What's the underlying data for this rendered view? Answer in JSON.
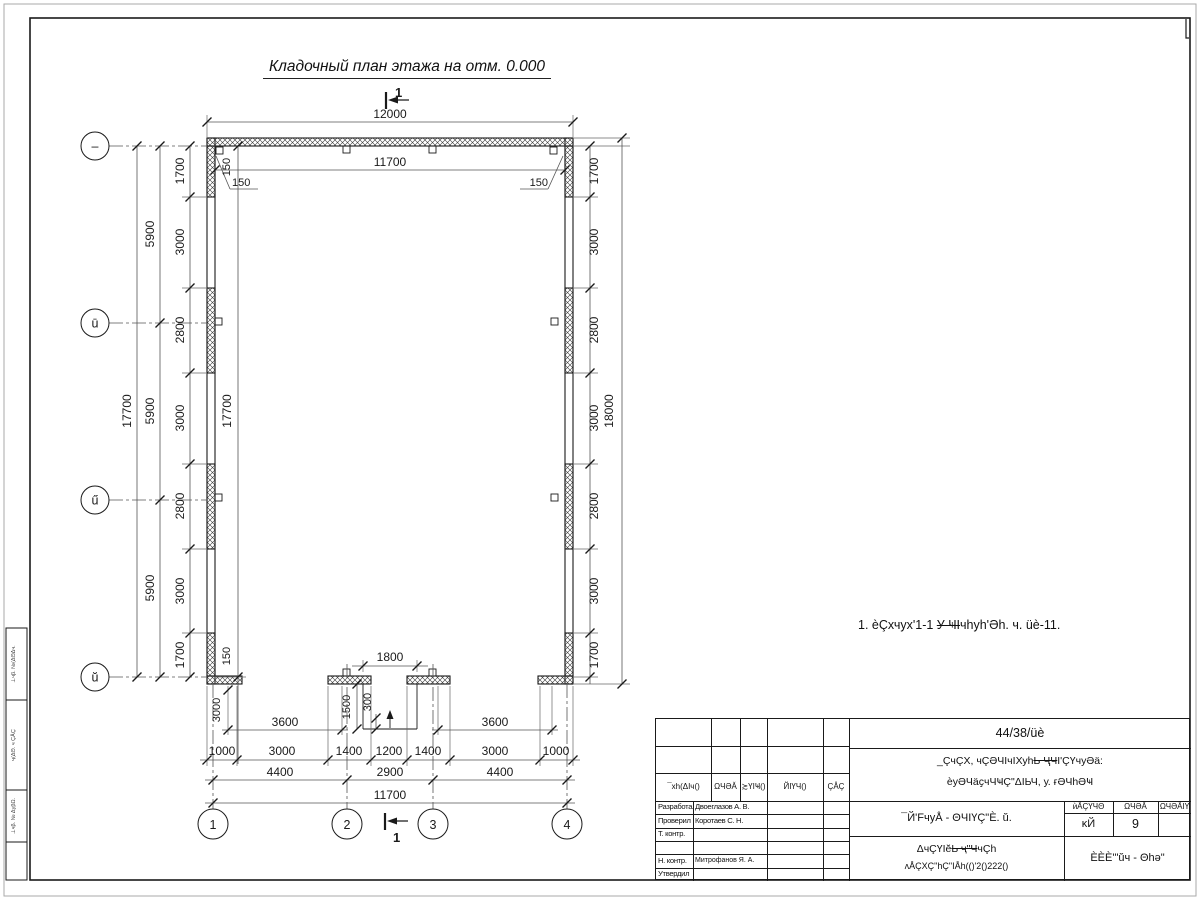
{
  "title": "Кладочный план этажа на отм. 0.000",
  "note": {
    "pre": "1. èÇхчух'1-1 ",
    "struck": "У ҸI",
    "post": "чhуh'Әh. ч. üè-11."
  },
  "section_label": "1",
  "axes": {
    "rows": [
      "–",
      "ū",
      "ű",
      "ŭ"
    ],
    "cols": [
      "1",
      "2",
      "3",
      "4"
    ]
  },
  "dims": {
    "top_overall": "12000",
    "inner_w": "11700",
    "inner_h": "17700",
    "off150": "150",
    "left_chain": [
      "1700",
      "3000",
      "2800",
      "3000",
      "2800",
      "3000",
      "1700"
    ],
    "left_major": [
      "5900",
      "5900",
      "5900"
    ],
    "left_overall": "17700",
    "right_chain": [
      "1700",
      "3000",
      "2800",
      "3000",
      "2800",
      "3000",
      "1700"
    ],
    "right_overall": "18000",
    "bottom_chain": [
      "1000",
      "3000",
      "1400",
      "1200",
      "1400",
      "3000",
      "1000"
    ],
    "bottom_axes": [
      "4400",
      "2900",
      "4400"
    ],
    "bottom_overall": "11700",
    "gate": "3600",
    "door": "1800",
    "porch": "1500",
    "step": "300",
    "apron": "3000"
  },
  "titleblock": {
    "doc_number": "44/38/üè",
    "project_line1_pre": "_ÇчÇХ, чÇӘЧIчIХуh",
    "project_line1_struck": "Ь ҶЧ",
    "project_line1_post": "I'ÇҮчуӘӓ:",
    "project_line2": "ѐуӘЧӓҫчЧҸÇ\"ΔIЬЧ, у. ғӘЧhӘҸ",
    "rev_headers": [
      "¯хh(ΔIч()",
      "ΩЧӘĂ",
      "≿ҮIҸ()",
      "ЙIҮЧ()",
      "ÇÅÇ"
    ],
    "roles": [
      "Разработал",
      "Проверил",
      "Т. контр.",
      "",
      "Н. контр.",
      "Утвердил"
    ],
    "names": [
      "Двоеглазов А. В.",
      "Коротаев С. Н.",
      "",
      "",
      "Митрофанов Я. А.",
      ""
    ],
    "sheet_title_line": "¯Й'FчуÅ - ΘЧIҮÇ\"È. ŭ.",
    "doc_type_pre": "ΔчÇҮIĕ",
    "doc_type_struck": "Ь ҷ\"Ч",
    "doc_type_post": "чÇh",
    "doc_code": "ʌÅÇХÇ\"hÇ\"IÅh(()'2()222()",
    "stage_headers": [
      "ѝÅÇҮЧΘ",
      "ΩЧӘĂ",
      "ΩЧӘÅIҮ"
    ],
    "stage": "ĸЙ",
    "sheet_num": "9",
    "sheets_total": "",
    "company": "ÈÈÈ'\"ŭч - Θhә\""
  },
  "margin": {
    "box1": "⊥чβ. №(ΔΘΔч.",
    "box2": "ҷ(ΔΘ. ч ÇÅÇ",
    "box3": "⊥чβ. № ΔуβΩ."
  }
}
